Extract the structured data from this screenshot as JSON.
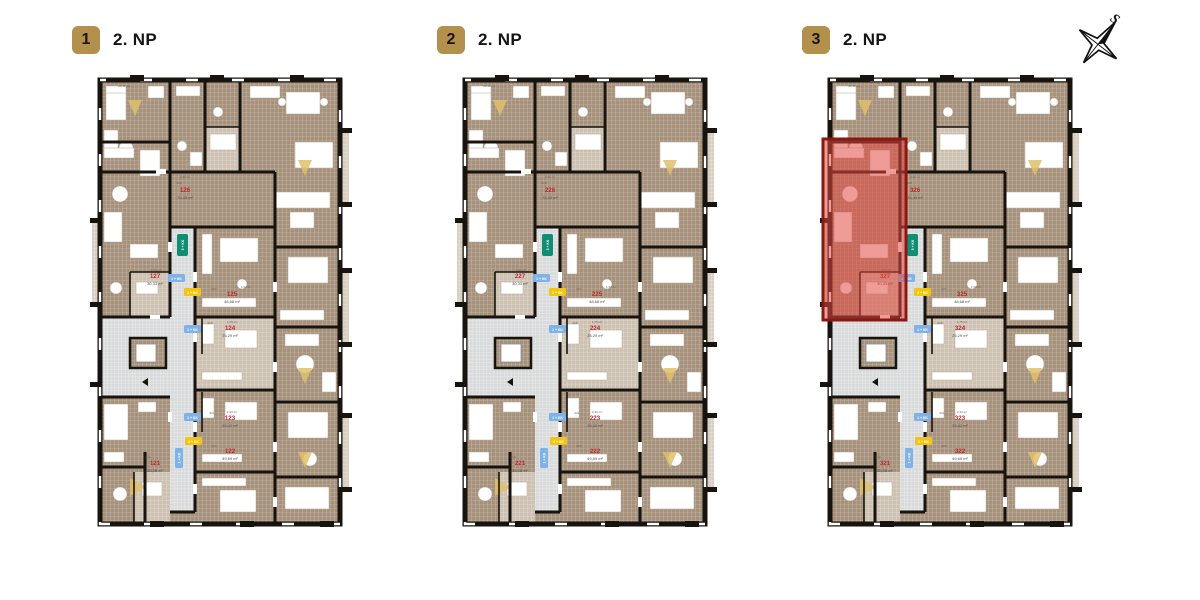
{
  "compass": {
    "label": "S"
  },
  "type_badges": {
    "green": "3 + KK",
    "blue": "1 + KK",
    "yellow": "2 + KK"
  },
  "colors": {
    "accent_gold": "#b3904b",
    "highlight_red": "#e24842",
    "unit_number_red": "#c0262c",
    "badge_green": "#0f8e74",
    "badge_blue": "#7fb3e8",
    "badge_yellow": "#f2c50f",
    "wall_black": "#17130e"
  },
  "micro": [
    "3,32 m²",
    "028",
    "2,41 m²",
    "027",
    "1,30 m²",
    "025",
    "1,75 m²",
    "021",
    "2,33 m²",
    "024",
    "019",
    "10,30 m²"
  ],
  "plans": [
    {
      "badge": "1",
      "title": "2. NP",
      "highlighted": false,
      "units": [
        {
          "id": "121",
          "area": "35,08 m²"
        },
        {
          "id": "122",
          "area": "49,69 m²"
        },
        {
          "id": "123",
          "area": "25,42 m²"
        },
        {
          "id": "124",
          "area": "25,29 m²"
        },
        {
          "id": "125",
          "area": "48,68 m²"
        },
        {
          "id": "126",
          "area": "75,43 m²"
        },
        {
          "id": "127",
          "area": "30,33 m²"
        }
      ]
    },
    {
      "badge": "2",
      "title": "2. NP",
      "highlighted": false,
      "units": [
        {
          "id": "221",
          "area": "35,08 m²"
        },
        {
          "id": "222",
          "area": "49,69 m²"
        },
        {
          "id": "223",
          "area": "25,42 m²"
        },
        {
          "id": "224",
          "area": "25,29 m²"
        },
        {
          "id": "225",
          "area": "48,68 m²"
        },
        {
          "id": "226",
          "area": "75,43 m²"
        },
        {
          "id": "227",
          "area": "30,33 m²"
        }
      ]
    },
    {
      "badge": "3",
      "title": "2. NP",
      "highlighted": true,
      "highlight_unit": "327",
      "units": [
        {
          "id": "321",
          "area": "35,08 m²"
        },
        {
          "id": "322",
          "area": "49,69 m²"
        },
        {
          "id": "323",
          "area": "25,42 m²"
        },
        {
          "id": "324",
          "area": "25,29 m²"
        },
        {
          "id": "325",
          "area": "48,68 m²"
        },
        {
          "id": "326",
          "area": "75,43 m²"
        },
        {
          "id": "327",
          "area": "30,33 m²"
        }
      ]
    }
  ]
}
